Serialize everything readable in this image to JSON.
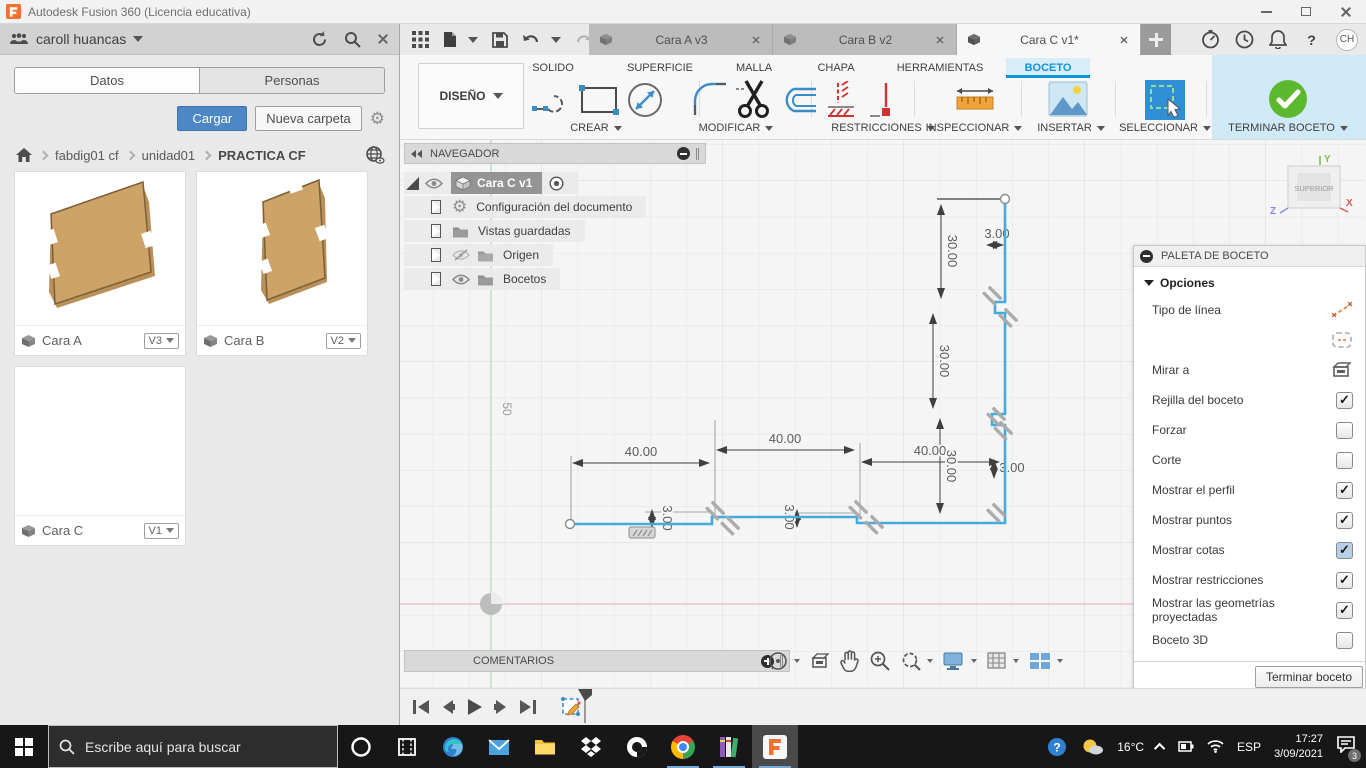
{
  "window": {
    "title": "Autodesk Fusion 360 (Licencia educativa)"
  },
  "data_panel": {
    "user_name": "caroll huancas",
    "tab_datos": "Datos",
    "tab_personas": "Personas",
    "upload": "Cargar",
    "new_folder": "Nueva carpeta",
    "breadcrumb": {
      "item1": "fabdig01 cf",
      "item2": "unidad01",
      "item3": "PRACTICA CF"
    },
    "cards": [
      {
        "name": "Cara A",
        "version": "V3"
      },
      {
        "name": "Cara B",
        "version": "V2"
      },
      {
        "name": "Cara C",
        "version": "V1"
      }
    ]
  },
  "doc_tabs": {
    "tab1": "Cara A v3",
    "tab2": "Cara B v2",
    "tab3": "Cara C v1*"
  },
  "account": {
    "initials": "CH"
  },
  "icons": {
    "help": "?"
  },
  "ribbon": {
    "workspace": "DISEÑO",
    "tab_solido": "SOLIDO",
    "tab_superficie": "SUPERFICIE",
    "tab_malla": "MALLA",
    "tab_chapa": "CHAPA",
    "tab_herramientas": "HERRAMIENTAS",
    "tab_boceto": "BOCETO",
    "g_crear": "CREAR",
    "g_modificar": "MODIFICAR",
    "g_restricciones": "RESTRICCIONES",
    "g_inspeccionar": "INSPECCIONAR",
    "g_insertar": "INSERTAR",
    "g_seleccionar": "SELECCIONAR",
    "g_terminar": "TERMINAR BOCETO"
  },
  "navigator": {
    "title": "NAVEGADOR",
    "root_label": "Cara C v1",
    "row_config": "Configuración del documento",
    "row_vistas": "Vistas guardadas",
    "row_origen": "Origen",
    "row_bocetos": "Bocetos"
  },
  "viewcube": {
    "face": "SUPERIOR",
    "axis_x": "X",
    "axis_y": "Y",
    "axis_z": "Z"
  },
  "canvas": {
    "grid_label": "50",
    "dims": {
      "w1": "40.00",
      "w2": "40.00",
      "w3": "40.00",
      "h1": "30.00",
      "h2": "30.00",
      "h3": "30.00",
      "t_top": "3.00",
      "t_right": "3.00",
      "t_bottom1": "3.00",
      "t_bottom2": "3.00"
    }
  },
  "palette": {
    "title": "PALETA DE BOCETO",
    "section": "Opciones",
    "rows": [
      {
        "label": "Tipo de línea",
        "type": "icon",
        "checked": null
      },
      {
        "label": "",
        "type": "icon",
        "checked": null
      },
      {
        "label": "Mirar a",
        "type": "icon",
        "checked": null
      },
      {
        "label": "Rejilla del boceto",
        "type": "checkbox",
        "checked": true
      },
      {
        "label": "Forzar",
        "type": "checkbox",
        "checked": false
      },
      {
        "label": "Corte",
        "type": "checkbox",
        "checked": false
      },
      {
        "label": "Mostrar el perfil",
        "type": "checkbox",
        "checked": true
      },
      {
        "label": "Mostrar puntos",
        "type": "checkbox",
        "checked": true
      },
      {
        "label": "Mostrar cotas",
        "type": "checkbox",
        "checked": true,
        "highlight": true
      },
      {
        "label": "Mostrar restricciones",
        "type": "checkbox",
        "checked": true
      },
      {
        "label": "Mostrar las geometrías proyectadas",
        "type": "checkbox",
        "checked": true
      },
      {
        "label": "Boceto 3D",
        "type": "checkbox",
        "checked": false
      }
    ],
    "finish_button": "Terminar boceto"
  },
  "comments": {
    "title": "COMENTARIOS"
  },
  "taskbar": {
    "search_placeholder": "Escribe aquí para buscar",
    "temp": "16°C",
    "lang": "ESP",
    "time": "17:27",
    "date": "3/09/2021",
    "notif_count": "3"
  },
  "colors": {
    "accent_blue": "#0a96d6",
    "sketch_blue": "#45aade",
    "upload_blue": "#4e87c6",
    "check_green": "#5cb82e"
  }
}
